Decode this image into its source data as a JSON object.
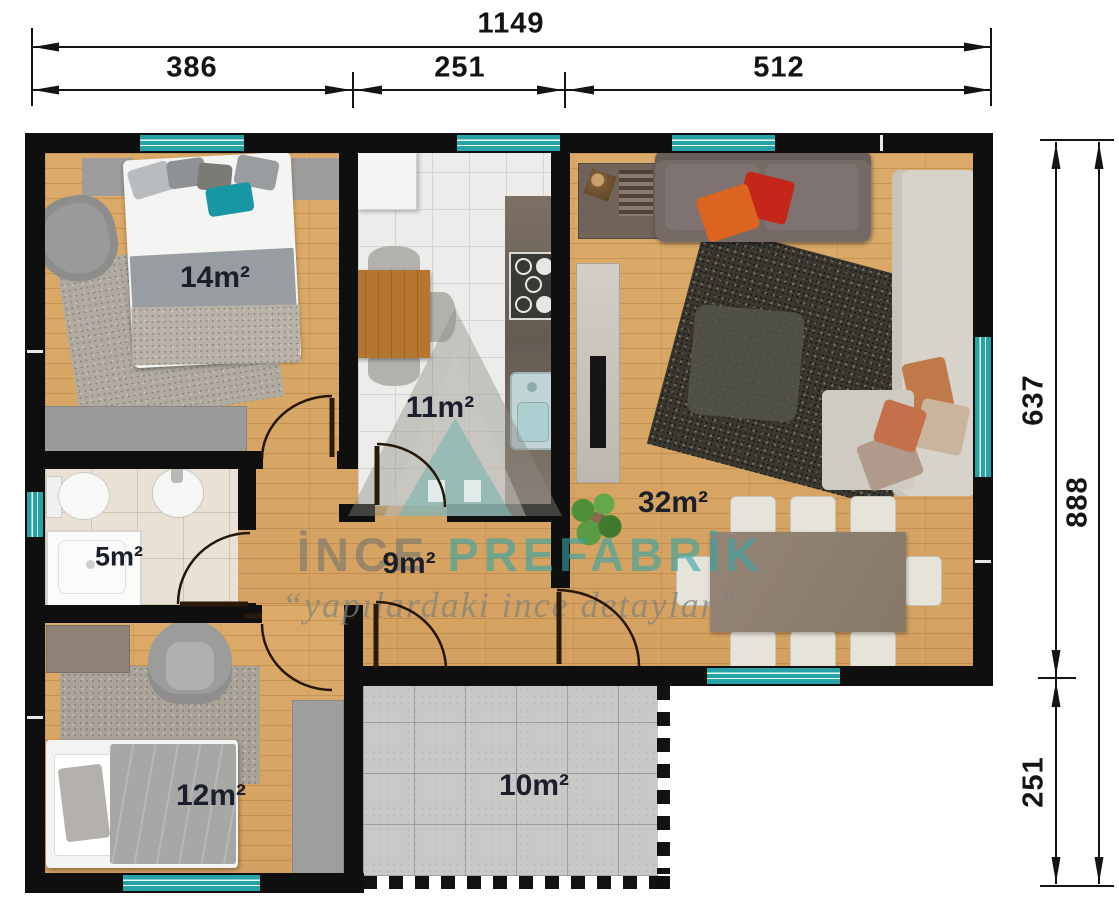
{
  "plan": {
    "type": "floor-plan",
    "brand": {
      "first": "İNCE",
      "second": "PREFABRİK",
      "slogan": "“yapılardaki ince detaylar”"
    },
    "rooms": [
      {
        "id": "bedroom-large",
        "area_label": "14m²"
      },
      {
        "id": "kitchen",
        "area_label": "11m²"
      },
      {
        "id": "living-room",
        "area_label": "32m²"
      },
      {
        "id": "bathroom",
        "area_label": "5m²"
      },
      {
        "id": "hallway",
        "area_label": "9m²"
      },
      {
        "id": "bedroom-small",
        "area_label": "12m²"
      },
      {
        "id": "terrace",
        "area_label": "10m²"
      }
    ],
    "dimensions": {
      "top_total": "1149",
      "top_segments": [
        "386",
        "251",
        "512"
      ],
      "right_outer": "888",
      "right_segments": [
        "637",
        "251"
      ]
    },
    "colors": {
      "window_teal": "#2aa9ab",
      "wall_black": "#0f0f0f",
      "wood_floor": "#d9a766",
      "dimension_text": "#141414",
      "label_text": "#1a1f2b"
    }
  }
}
